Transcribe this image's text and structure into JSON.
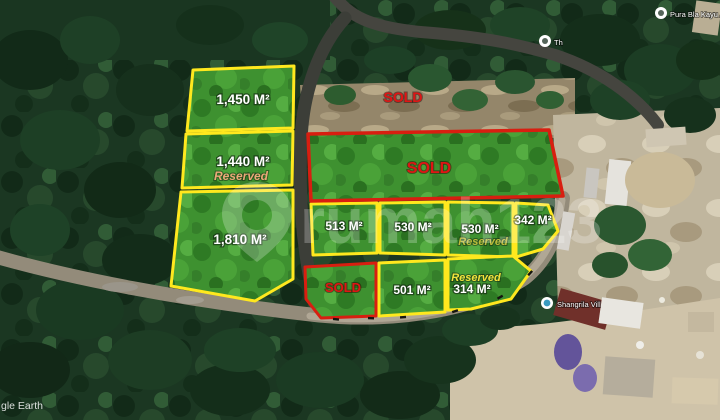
{
  "map": {
    "attribution": "gle Earth",
    "watermark": "rumah123",
    "markers": [
      {
        "label": "Pura Bla Kayu A"
      },
      {
        "label": "Th"
      },
      {
        "label": "Shangrila Vill"
      }
    ]
  },
  "plots": {
    "p1450": {
      "area": "1,450 M²"
    },
    "p1440": {
      "area": "1,440 M²",
      "status": "Reserved"
    },
    "p1810": {
      "area": "1,810 M²"
    },
    "sold_top": {
      "status": "SOLD"
    },
    "sold_main": {
      "status": "SOLD"
    },
    "p513": {
      "area": "513 M²"
    },
    "p530a": {
      "area": "530 M²"
    },
    "p530b": {
      "area": "530 M²",
      "status": "Reserved"
    },
    "p342": {
      "area": "342 M²"
    },
    "sold_small": {
      "status": "SOLD"
    },
    "p501": {
      "area": "501 M²"
    },
    "p314": {
      "area": "314 M²",
      "status": "Reserved"
    }
  },
  "colors": {
    "plot_outline": "#ffe81e",
    "sold_outline": "#d81e10",
    "sold_text": "#e01414",
    "reserved_warm": "#eaa878",
    "reserved_olive": "#bcbc3a",
    "reserved_yellow": "#f2e23c"
  }
}
